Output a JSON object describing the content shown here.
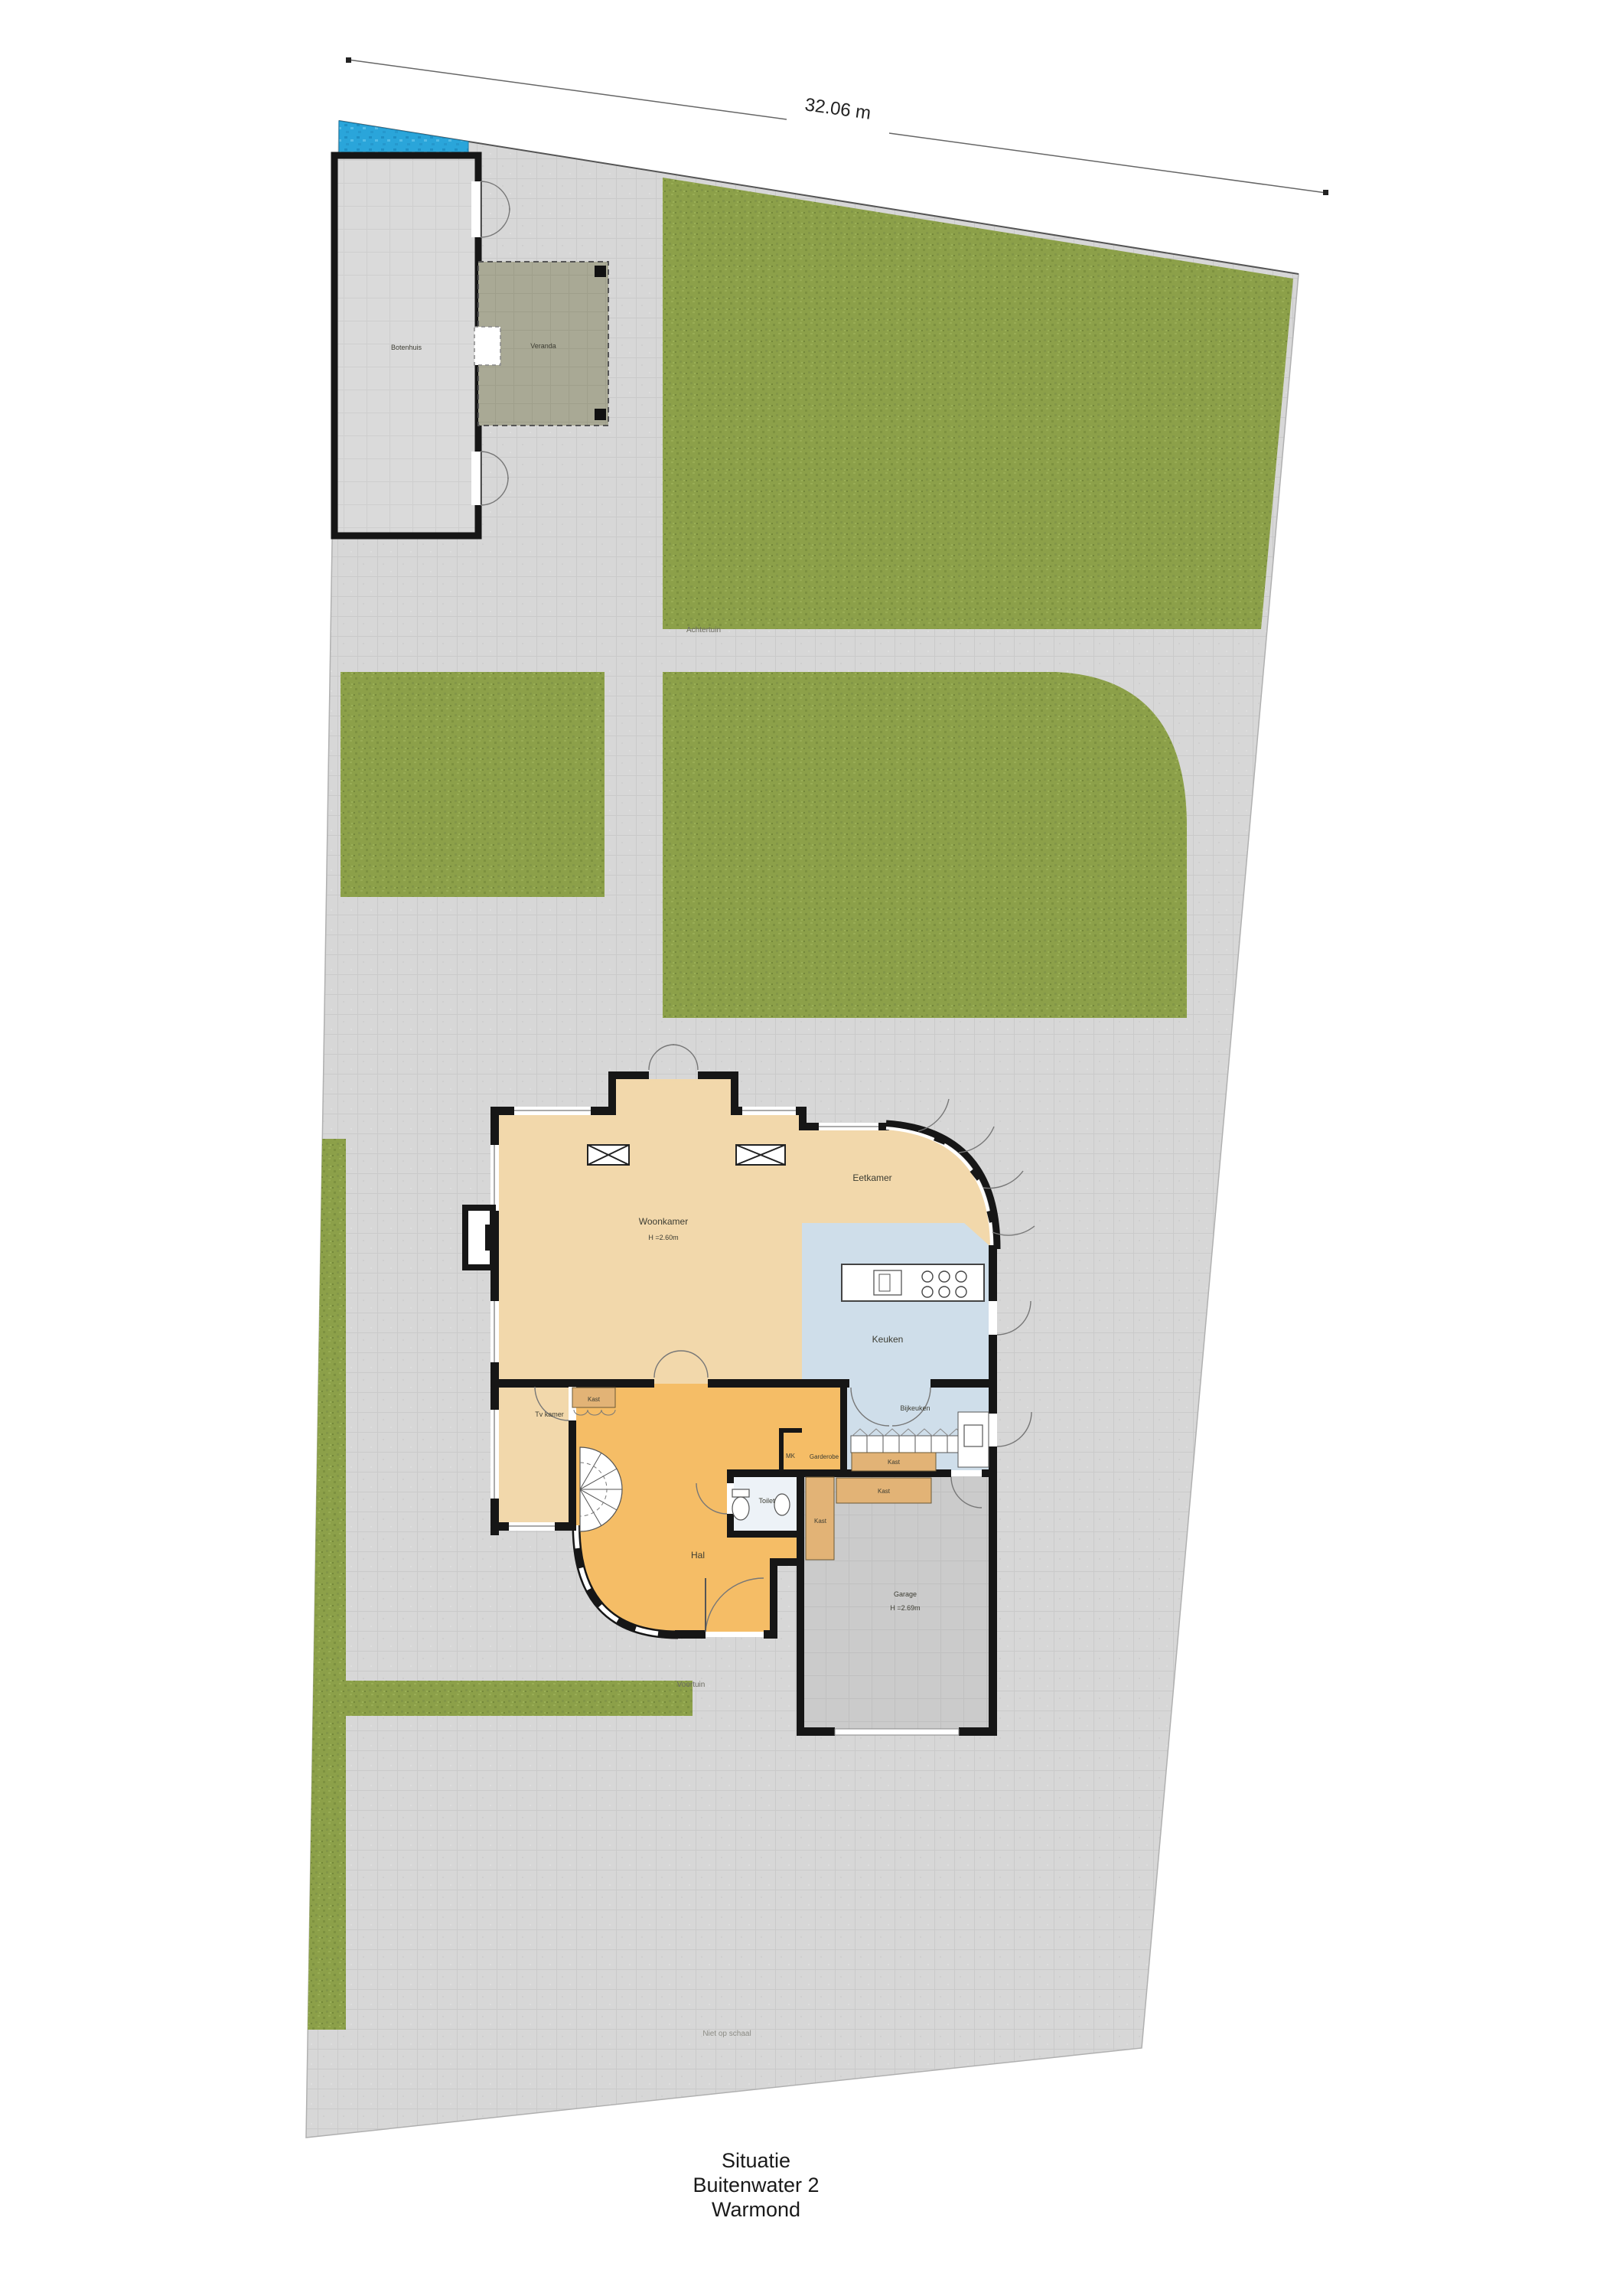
{
  "title_block": {
    "line1": "Situatie",
    "line2": "Buitenwater 2",
    "line3": "Warmond"
  },
  "dimension": {
    "width_label": "32.06 m"
  },
  "site": {
    "achtertuin": "Achtertuin",
    "voortuin": "Voortuin",
    "scale_note": "Niet op schaal",
    "botenhuis": "Botenhuis",
    "veranda": "Veranda"
  },
  "rooms": {
    "woonkamer": "Woonkamer",
    "woonkamer_height": "H =2.60m",
    "eetkamer": "Eetkamer",
    "keuken": "Keuken",
    "bijkeuken": "Bijkeuken",
    "hal": "Hal",
    "toilet": "Toilet",
    "garderobe": "Garderobe",
    "meterkast": "MK",
    "tv_kamer": "Tv kamer",
    "garage": "Garage",
    "garage_height": "H =2.69m",
    "kast": "Kast"
  },
  "colors": {
    "grass": "#8ca049",
    "paving": "#d7d7d7",
    "water": "#2aa5da",
    "living_floor": "#f2d8ab",
    "kitchen_floor": "#cfdeea",
    "hall_floor": "#f5bd66",
    "cabinet": "#e2b376",
    "garage_floor": "#cbcbcb",
    "wall": "#161616"
  }
}
